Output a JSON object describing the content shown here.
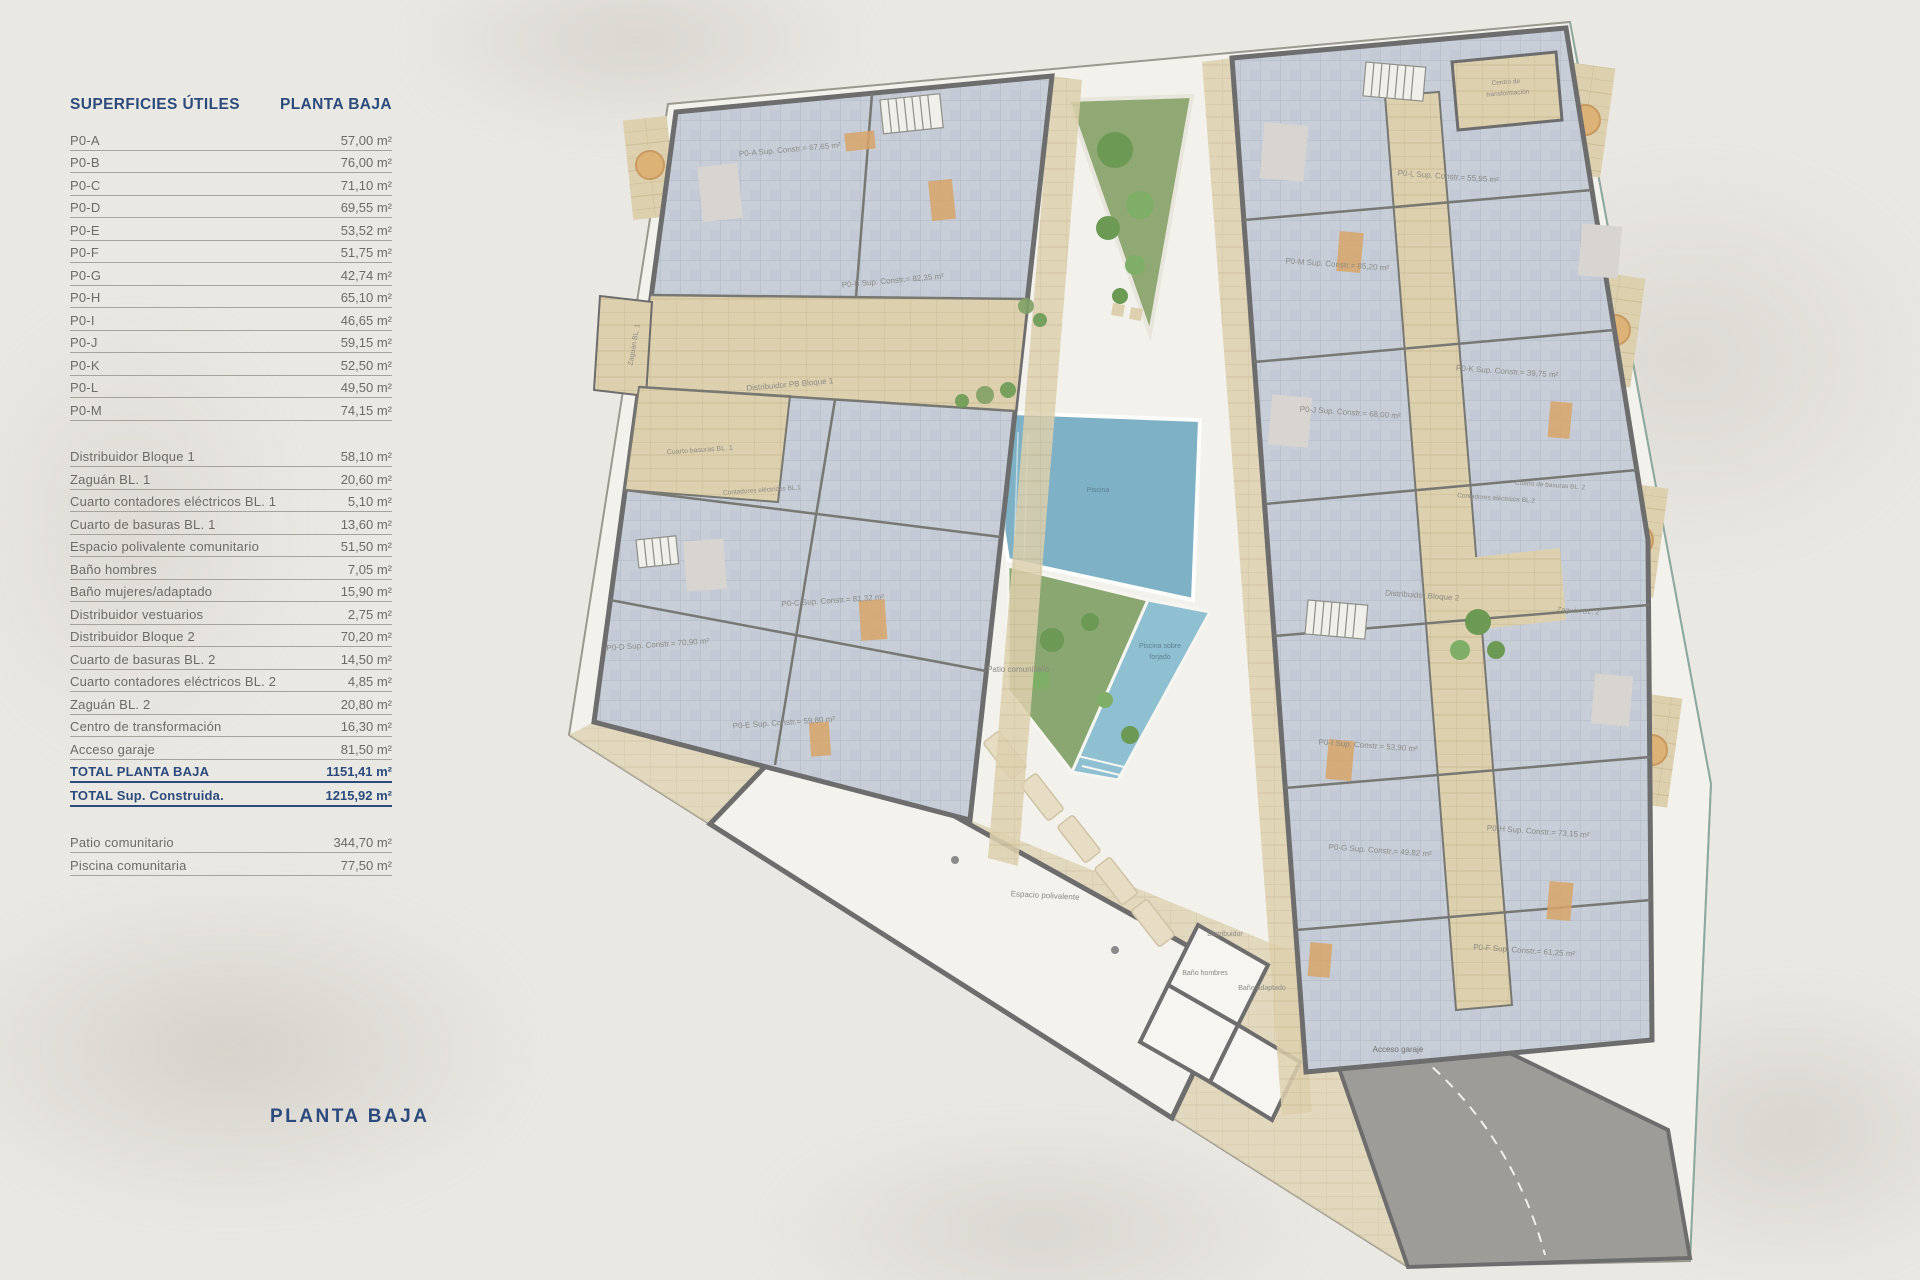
{
  "page": {
    "bottom_title": "PLANTA BAJA"
  },
  "table": {
    "title_left": "SUPERFICIES ÚTILES",
    "title_right": "PLANTA BAJA",
    "sections": [
      {
        "rows": [
          {
            "label": "P0-A",
            "value": "57,00 m²"
          },
          {
            "label": "P0-B",
            "value": "76,00 m²"
          },
          {
            "label": "P0-C",
            "value": "71,10 m²"
          },
          {
            "label": "P0-D",
            "value": "69,55 m²"
          },
          {
            "label": "P0-E",
            "value": "53,52 m²"
          },
          {
            "label": "P0-F",
            "value": "51,75 m²"
          },
          {
            "label": "P0-G",
            "value": "42,74 m²"
          },
          {
            "label": "P0-H",
            "value": "65,10 m²"
          },
          {
            "label": "P0-I",
            "value": "46,65 m²"
          },
          {
            "label": "P0-J",
            "value": "59,15 m²"
          },
          {
            "label": "P0-K",
            "value": "52,50 m²"
          },
          {
            "label": "P0-L",
            "value": "49,50 m²"
          },
          {
            "label": "P0-M",
            "value": "74,15 m²"
          }
        ]
      },
      {
        "rows": [
          {
            "label": "Distribuidor Bloque 1",
            "value": "58,10 m²"
          },
          {
            "label": "Zaguán BL. 1",
            "value": "20,60 m²"
          },
          {
            "label": "Cuarto contadores eléctricos BL. 1",
            "value": "5,10 m²"
          },
          {
            "label": "Cuarto de basuras BL. 1",
            "value": "13,60 m²"
          },
          {
            "label": "Espacio polivalente comunitario",
            "value": "51,50 m²"
          },
          {
            "label": "Baño hombres",
            "value": "7,05 m²"
          },
          {
            "label": "Baño mujeres/adaptado",
            "value": "15,90 m²"
          },
          {
            "label": "Distribuidor vestuarios",
            "value": "2,75 m²"
          },
          {
            "label": "Distribuidor Bloque 2",
            "value": "70,20 m²"
          },
          {
            "label": "Cuarto de basuras BL. 2",
            "value": "14,50 m²"
          },
          {
            "label": "Cuarto contadores eléctricos BL. 2",
            "value": "4,85 m²"
          },
          {
            "label": "Zaguán BL. 2",
            "value": "20,80 m²"
          },
          {
            "label": "Centro de transformación",
            "value": "16,30 m²"
          },
          {
            "label": "Acceso garaje",
            "value": "81,50 m²"
          },
          {
            "label": "TOTAL PLANTA BAJA",
            "value": "1151,41 m²",
            "total": true
          },
          {
            "label": "TOTAL Sup. Construida.",
            "value": "1215,92 m²",
            "total": true
          }
        ]
      },
      {
        "rows": [
          {
            "label": "Patio comunitario",
            "value": "344,70 m²"
          },
          {
            "label": "Piscina comunitaria",
            "value": "77,50 m²"
          }
        ]
      }
    ]
  },
  "plan": {
    "labels": {
      "p0a": "P0-A Sup. Constr.= 67,65 m²",
      "p0b": "P0-B Sup. Constr.= 82,35 m²",
      "p0c": "P0-C Sup. Constr.= 81,32 m²",
      "p0d": "P0-D Sup. Constr.= 70,90 m²",
      "p0e": "P0-E Sup. Constr.= 59,80 m²",
      "p0f": "P0-F Sup. Constr.= 61,25 m²",
      "p0g": "P0-G Sup. Constr.= 49,82 m²",
      "p0h": "P0-H Sup. Constr.= 73,15 m²",
      "p0i": "P0-I Sup. Constr.= 53,90 m²",
      "p0j": "P0-J Sup. Constr.= 68,00 m²",
      "p0k": "P0-K Sup. Constr.= 39,75 m²",
      "p0l": "P0-L Sup. Constr.= 55,95 m²",
      "p0m": "P0-M Sup. Constr.= 85,20 m²",
      "dist1": "Distribuidor PB Bloque 1",
      "dist2": "Distribuidor Bloque 2",
      "zaguan1": "Zaguán BL. 1",
      "zaguan2": "Zaguán BL. 2",
      "basuras1": "Cuarto basuras BL. 1",
      "contadores1": "Contadores eléctricos BL.1",
      "basuras2": "Cuarto de basuras BL. 2",
      "contadores2": "Contadores eléctricos BL.2",
      "piscina": "Piscina",
      "piscina_forjado_1": "Piscina sobre",
      "piscina_forjado_2": "forjado",
      "patio": "Patio comunitario",
      "espacio": "Espacio polivalente",
      "distribuidor": "Distribuidor",
      "banio_hombres": "Baño hombres",
      "banio_adaptado": "Baño adaptado",
      "acceso": "Acceso garaje",
      "centro_1": "Centro de",
      "centro_2": "transformación"
    }
  },
  "colors": {
    "accent_navy": "#2c4b7c",
    "row_gray": "#6c6b65",
    "background": "#eae8e3",
    "tile_blue": "#c8ced8",
    "corridor_beige": "#ddd0ae",
    "wall_gray": "#6d6d6d",
    "pool_blue": "#7eb1c5",
    "garden_green": "#90a873",
    "garage_gray": "#9d9c99"
  }
}
